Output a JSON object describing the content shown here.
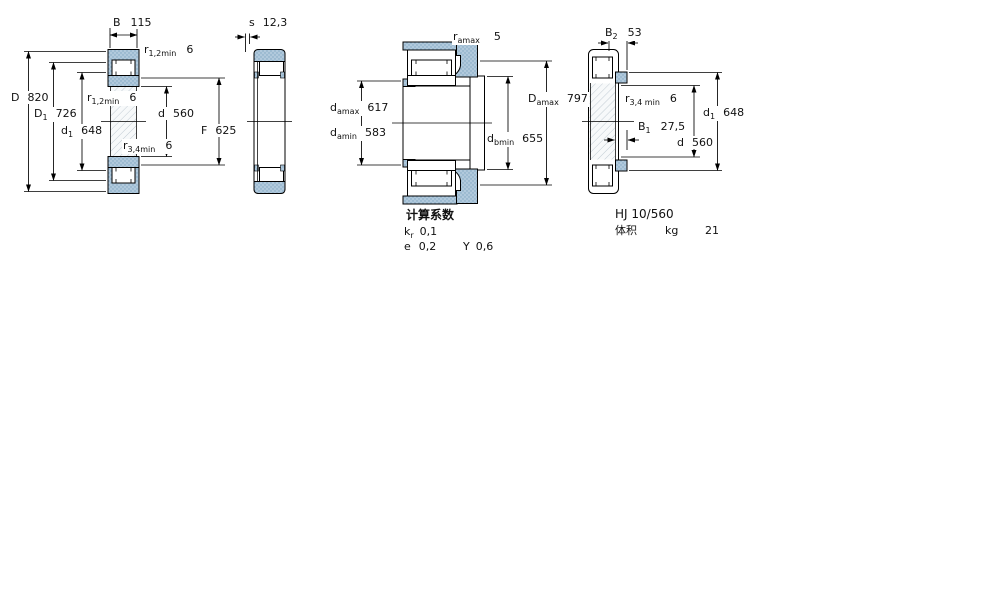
{
  "colors": {
    "section_fill_blue": "#b1c9dc",
    "section_dot_blue": "#7fa6c2",
    "hatch_gray": "#c2ccd4",
    "line_black": "#000000",
    "background": "#ffffff"
  },
  "views": {
    "front": {
      "title": "bearing cross section, front view",
      "labels": {
        "B": {
          "sym": "B",
          "val": "115"
        },
        "r12_top": {
          "sym": "r",
          "sub": "1,2min",
          "val": "6"
        },
        "D": {
          "sym": "D",
          "val": "820"
        },
        "D1": {
          "sym": "D",
          "sub": "1",
          "val": "726"
        },
        "d1": {
          "sym": "d",
          "sub": "1",
          "val": "648"
        },
        "r12_mid": {
          "sym": "r",
          "sub": "1,2min",
          "val": "6"
        },
        "d": {
          "sym": "d",
          "val": "560"
        },
        "F": {
          "sym": "F",
          "val": "625"
        },
        "r34": {
          "sym": "r",
          "sub": "3,4min",
          "val": "6"
        }
      }
    },
    "side": {
      "title": "bearing cross section, side view",
      "labels": {
        "s": {
          "sym": "s",
          "val": "12,3"
        }
      }
    },
    "mounted": {
      "title": "mounted bearing with abutments",
      "labels": {
        "r_a": {
          "sym": "r",
          "sub": "amax",
          "val": "5"
        },
        "d_amax": {
          "sym": "d",
          "sub": "amax",
          "val": "617"
        },
        "d_amin": {
          "sym": "d",
          "sub": "amin",
          "val": "583"
        },
        "d_bmin": {
          "sym": "d",
          "sub": "bmin",
          "val": "655"
        },
        "D_amax": {
          "sym": "D",
          "sub": "amax",
          "val": "797"
        }
      }
    },
    "ring": {
      "title": "HJ angle ring cross section",
      "labels": {
        "B2": {
          "sym": "B",
          "sub": "2",
          "val": "53"
        },
        "r34": {
          "sym": "r",
          "sub": "3,4 min",
          "val": "6"
        },
        "B1": {
          "sym": "B",
          "sub": "1",
          "val": "27,5"
        },
        "d1": {
          "sym": "d",
          "sub": "1",
          "val": "648"
        },
        "d": {
          "sym": "d",
          "val": "560"
        }
      }
    }
  },
  "calc_factors": {
    "heading": "计算系数",
    "kr": {
      "sym": "k",
      "sub": "r",
      "val": "0,1"
    },
    "e": {
      "sym": "e",
      "val": "0,2"
    },
    "Y": {
      "sym": "Y",
      "val": "0,6"
    }
  },
  "ring_info": {
    "designation": "HJ 10/560",
    "mass_label": "体积",
    "mass_unit": "kg",
    "mass_value": "21"
  }
}
